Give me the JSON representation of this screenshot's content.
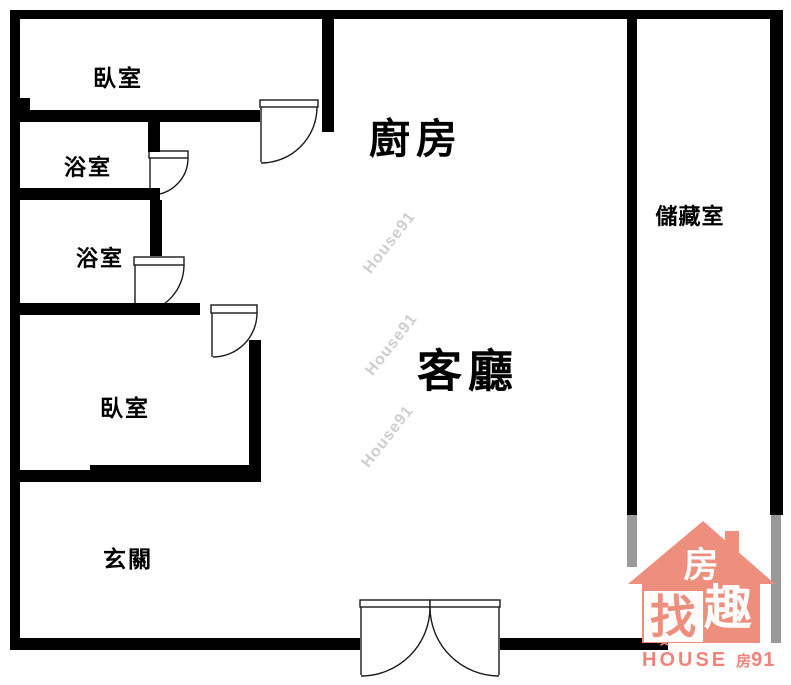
{
  "plan": {
    "type": "floor-plan",
    "wall_color": "#000000",
    "window_color": "#999999",
    "background": "#ffffff",
    "label_color": "#000000"
  },
  "rooms": {
    "bedroom_top": {
      "label": "臥室"
    },
    "bathroom_upper": {
      "label": "浴室"
    },
    "bathroom_lower": {
      "label": "浴室"
    },
    "bedroom_bottom": {
      "label": "臥室"
    },
    "kitchen": {
      "label": "廚房"
    },
    "living_room": {
      "label": "客廳"
    },
    "storage": {
      "label": "儲藏室"
    },
    "entrance": {
      "label": "玄關"
    }
  },
  "watermark": {
    "text": "House91",
    "color": "#c9c9c9"
  },
  "logo": {
    "coral": "#ee8f7d",
    "text_coral": "#f2837b",
    "white": "#ffffff",
    "roof_char": "房",
    "box_char": "找",
    "body_char": "趣",
    "brand_word": "HOUSE",
    "brand_caret": "ˆ",
    "brand_suffix_cjk": "房",
    "brand_suffix_num": "91"
  }
}
